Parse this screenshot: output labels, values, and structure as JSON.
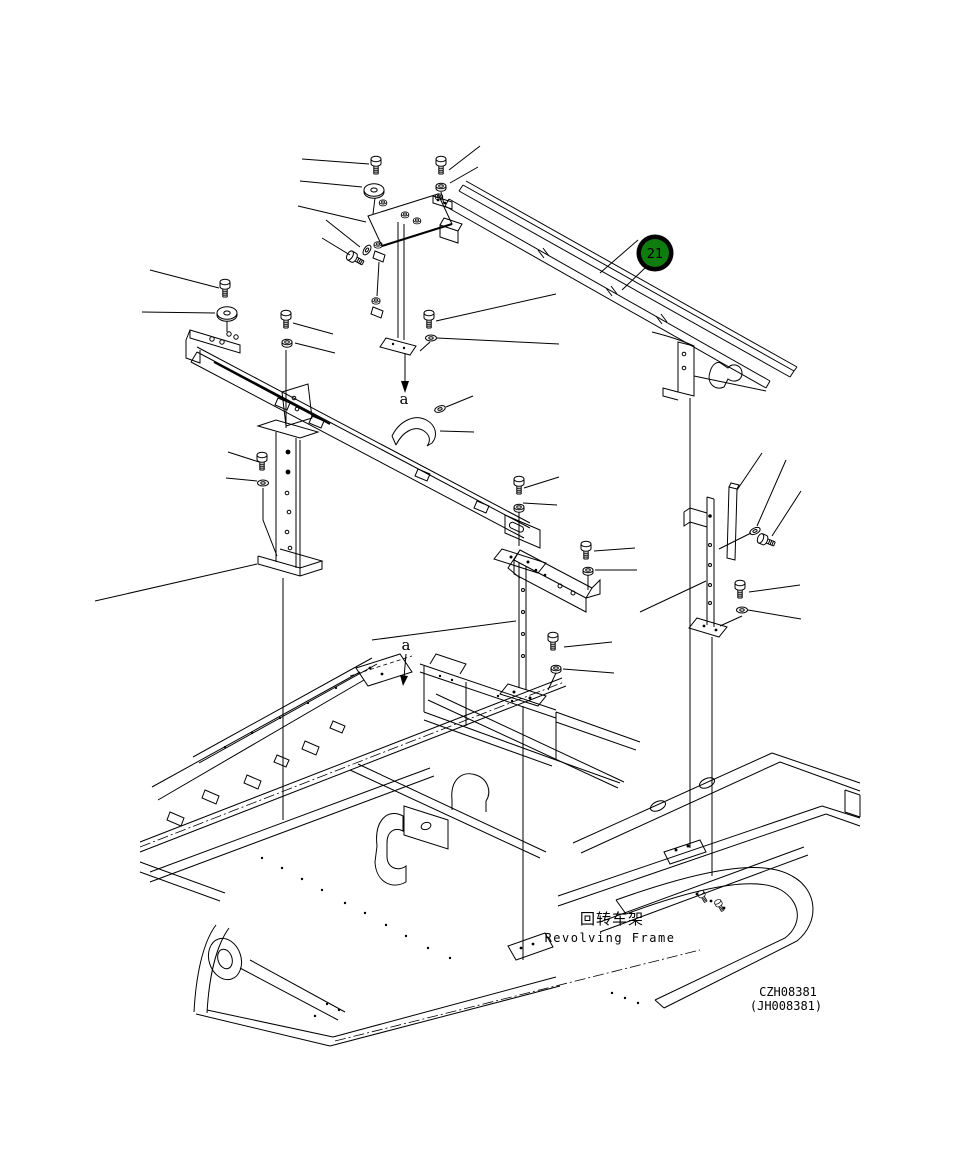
{
  "title": {
    "zh": "回转车架",
    "en": "Revolving Frame"
  },
  "drawing_numbers": {
    "code": "CZH08381",
    "alt": "(JH008381)"
  },
  "callout": {
    "label": "21",
    "fill": "#0e7c0e",
    "ring": "#000000",
    "text_color": "#ffffff"
  },
  "section_labels": {
    "top": "a",
    "bottom": "a"
  },
  "colors": {
    "line": "#000000",
    "background": "#ffffff"
  }
}
